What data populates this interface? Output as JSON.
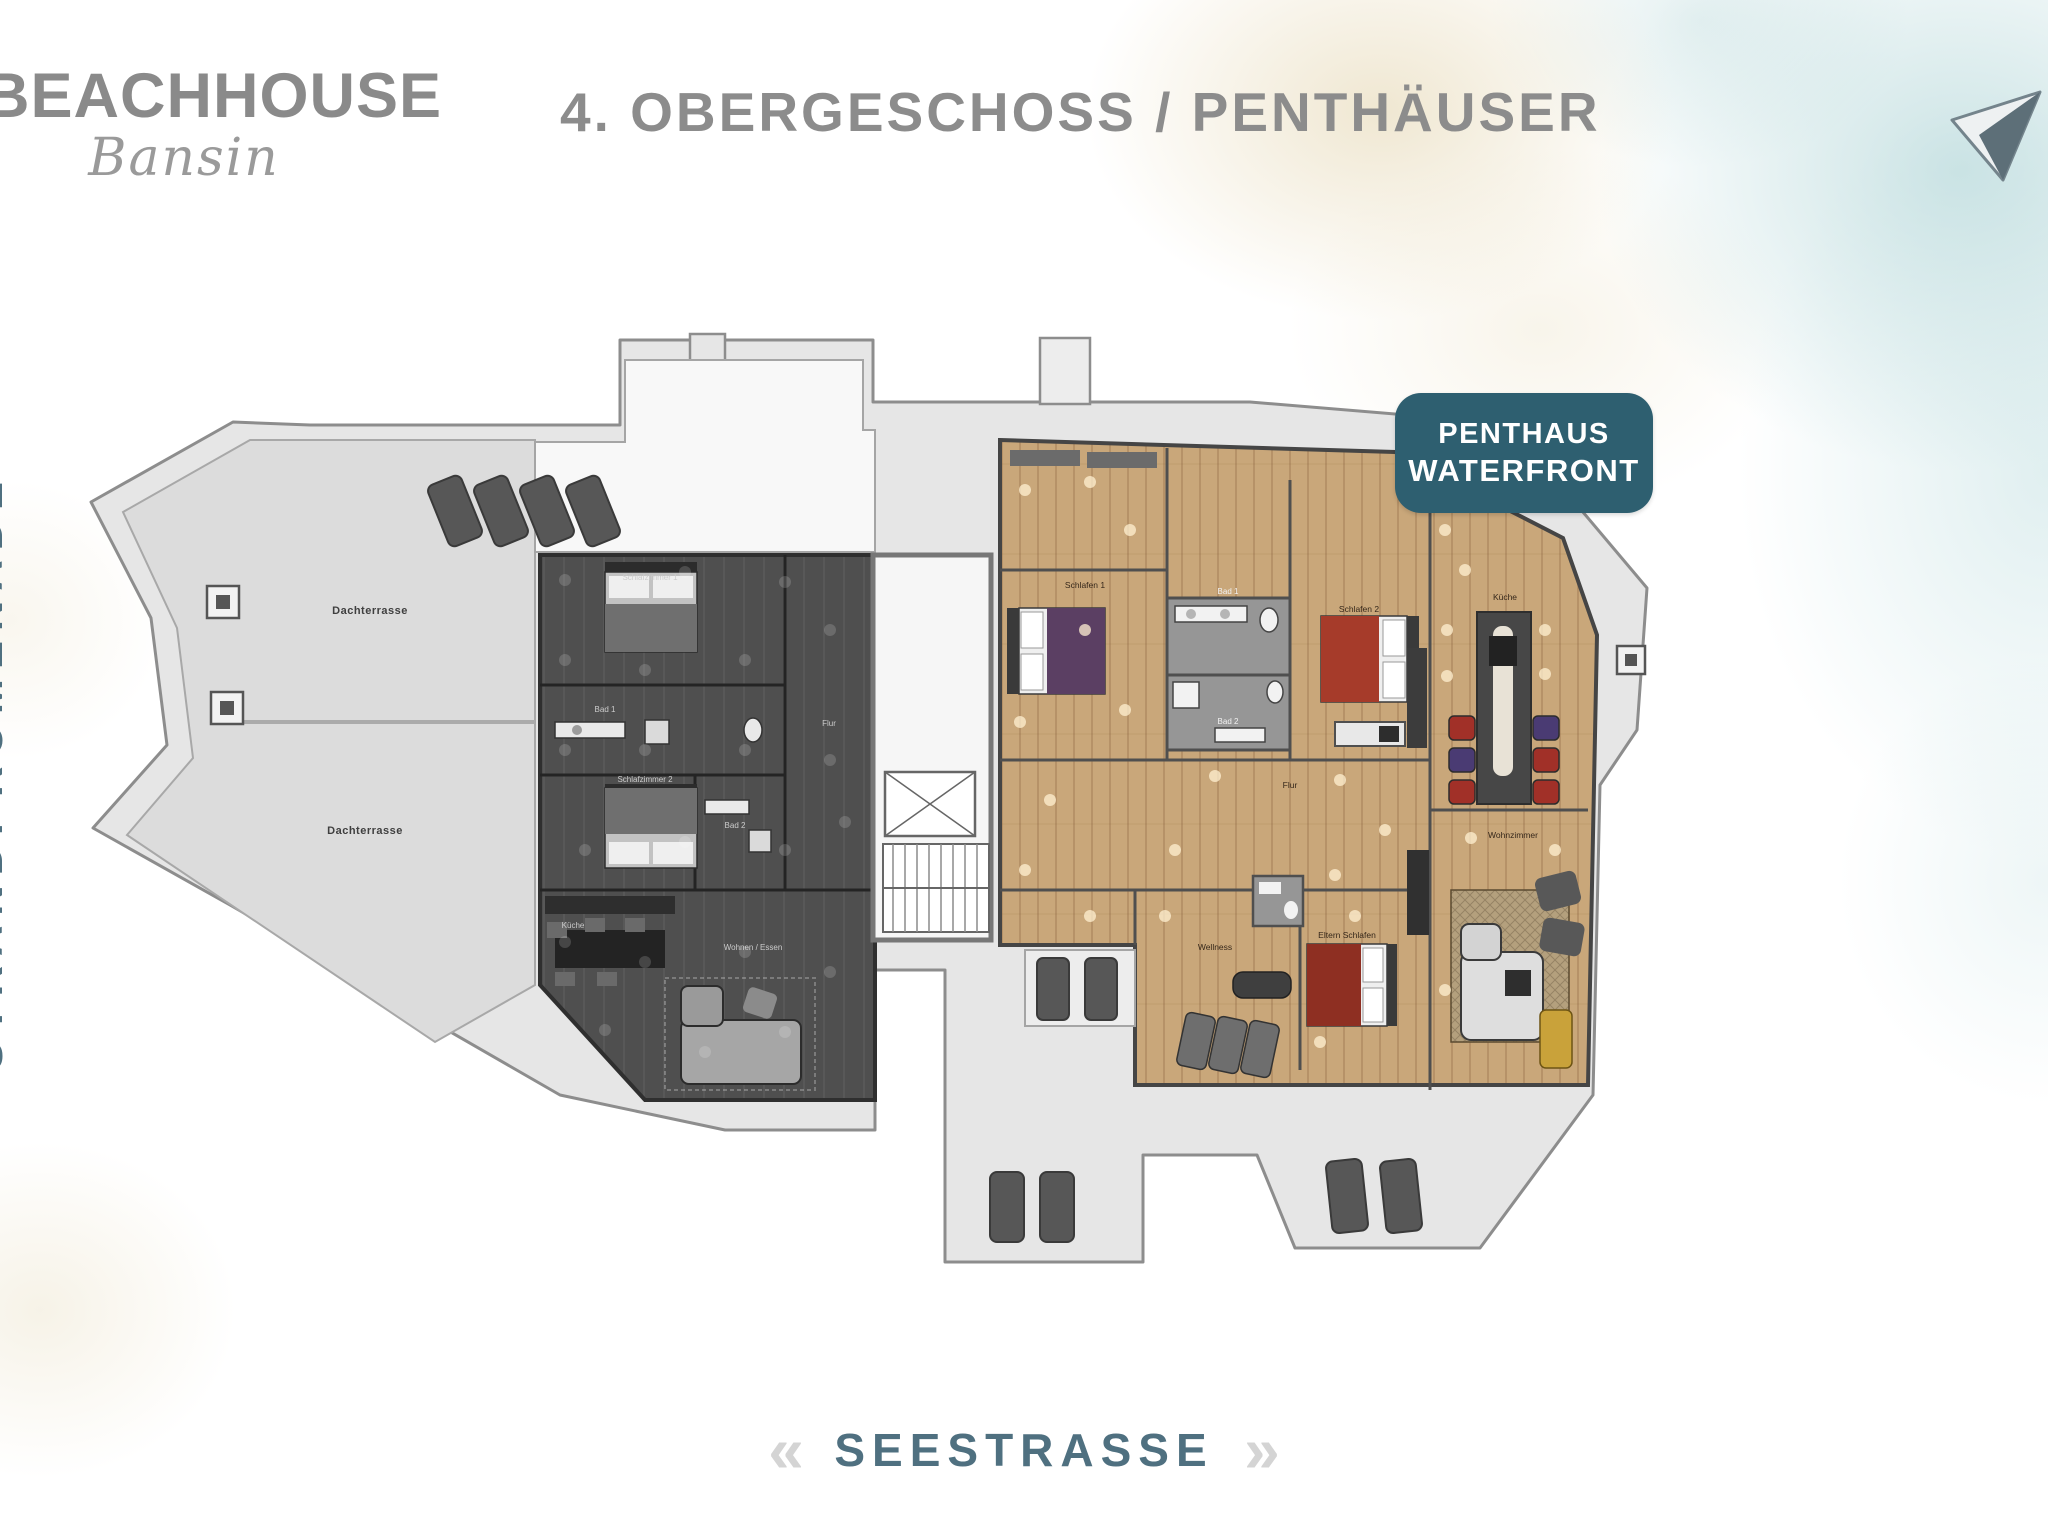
{
  "header": {
    "logo_title": "BEACHHOUSE",
    "logo_subtitle": "Bansin",
    "page_title": "4. OBERGESCHOSS / PENTHÄUSER"
  },
  "badge": {
    "line1": "PENTHAUS",
    "line2": "WATERFRONT",
    "color": "#2e5f70"
  },
  "streets": {
    "bottom": "SEESTRASSE",
    "left": "STRANDPROMENADE",
    "chevron_left": "«",
    "chevron_right": "»"
  },
  "floorplan": {
    "terraces": {
      "labels": [
        "Dachterrasse",
        "Dachterrasse"
      ]
    },
    "left_unit": {
      "style": "greyed-out",
      "rooms": [
        "Schlafzimmer 1",
        "Bad 1",
        "Schlafzimmer 2",
        "Bad 2",
        "Flur",
        "Küche",
        "Wohnen / Essen"
      ]
    },
    "right_unit": {
      "name": "Penthaus Waterfront",
      "rooms": [
        "Schlafen 1",
        "Bad 1",
        "Schlafen 2",
        "Bad 2",
        "Flur",
        "Küche",
        "Wohnzimmer",
        "Eltern Schlafen",
        "Wellness"
      ]
    }
  },
  "colors": {
    "accent_teal": "#2e5f70",
    "street_teal": "#4f7080",
    "heading_grey": "#8a8a8a",
    "wood_floor": "#c9a77a",
    "greyed_unit": "#4f4f4f"
  }
}
